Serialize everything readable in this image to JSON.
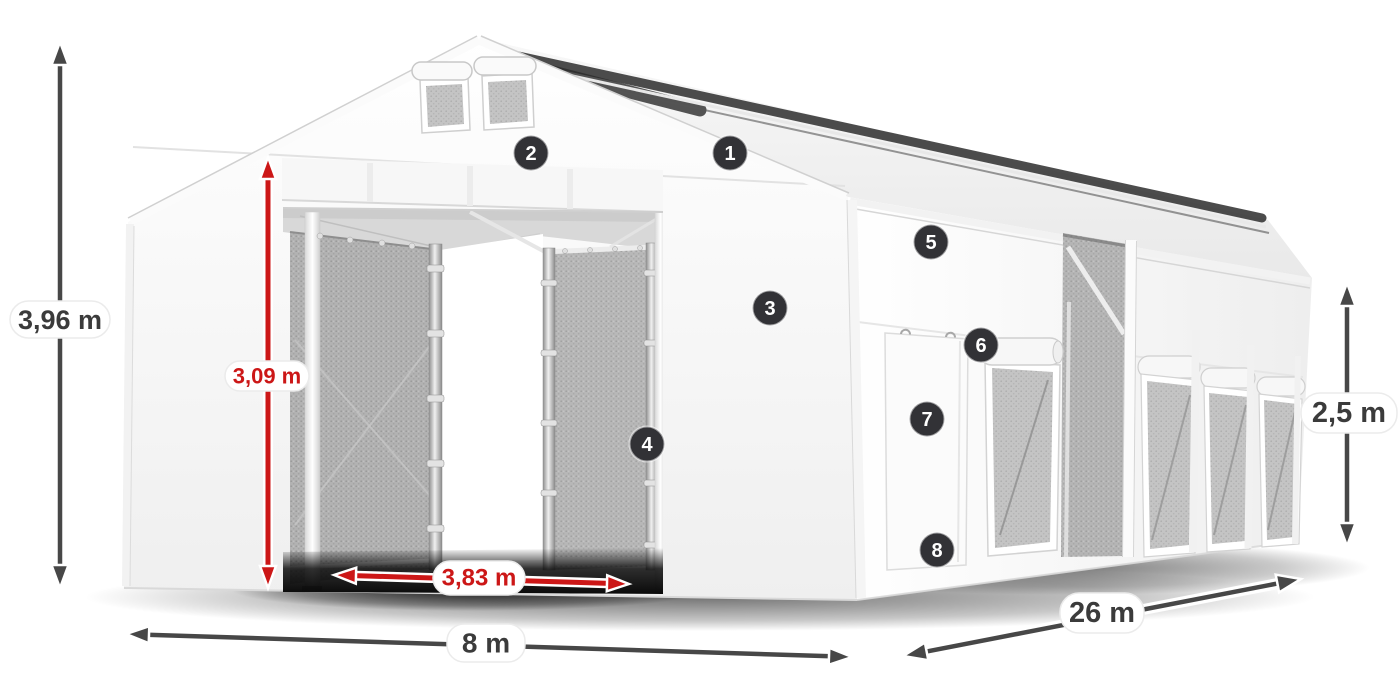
{
  "diagram": {
    "subject": "storage-tent-product-diagram"
  },
  "dimensions": {
    "total_height": "3,96 m",
    "entrance_height": "3,09 m",
    "entrance_width": "3,83 m",
    "width": "8 m",
    "length": "26 m",
    "side_wall_height": "2,5 m"
  },
  "callouts": {
    "c1": "1",
    "c2": "2",
    "c3": "3",
    "c4": "4",
    "c5": "5",
    "c6": "6",
    "c7": "7",
    "c8": "8"
  },
  "colors": {
    "accent_red": "#cc1717",
    "dimension_gray": "#474747",
    "label_text": "#3b3b3b",
    "badge_bg": "#323236",
    "badge_text": "#ffffff",
    "mesh_gray": "#b2b2b2",
    "tent_white": "#fbfbfb"
  }
}
